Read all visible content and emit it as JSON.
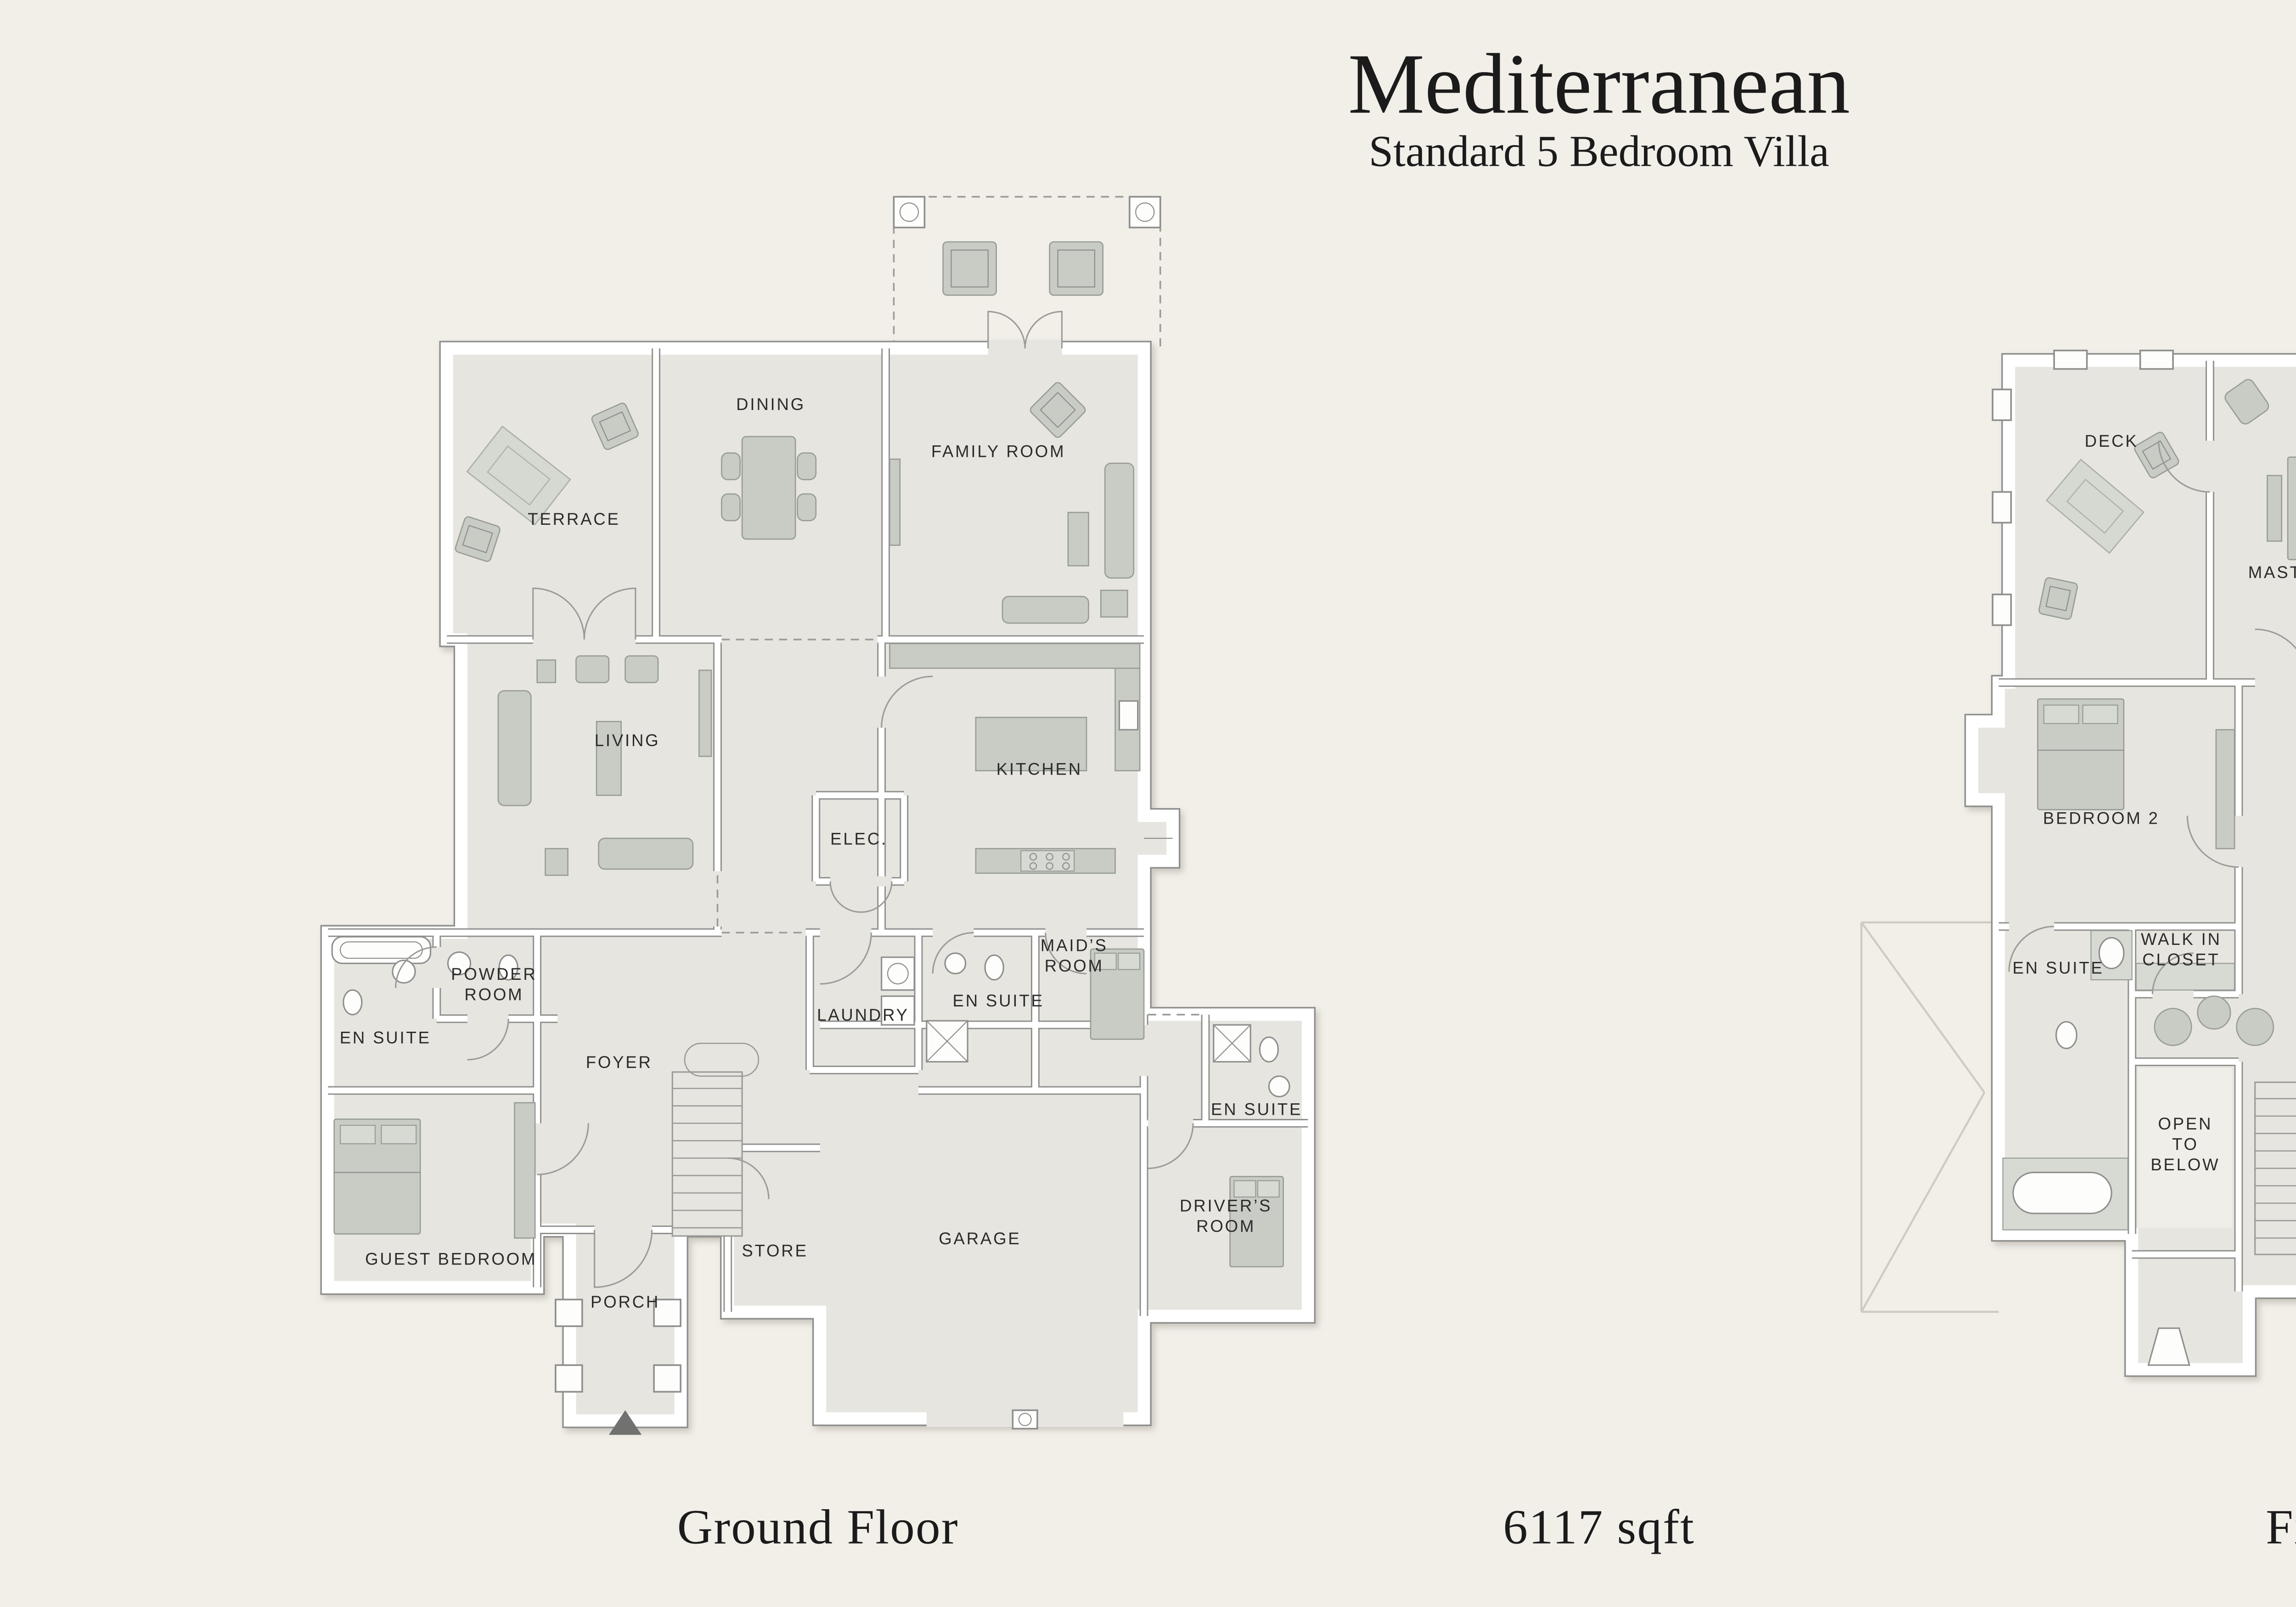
{
  "title": "Mediterranean",
  "subtitle": "Standard 5 Bedroom Villa",
  "area_label": "6117 sqft",
  "floors": {
    "ground": {
      "name": "Ground Floor",
      "rooms": {
        "terrace": "TERRACE",
        "dining": "DINING",
        "family_room": "FAMILY ROOM",
        "living": "LIVING",
        "kitchen": "KITCHEN",
        "elec": "ELEC.",
        "maids_room": [
          "MAID’S",
          "ROOM"
        ],
        "powder_room": [
          "POWDER",
          "ROOM"
        ],
        "en_suite_guest": "EN SUITE",
        "foyer": "FOYER",
        "laundry": "LAUNDRY",
        "en_suite_maid": "EN SUITE",
        "guest_bedroom": "GUEST BEDROOM",
        "store": "STORE",
        "porch": "PORCH",
        "garage": "GARAGE",
        "drivers_room": [
          "DRIVER’S",
          "ROOM"
        ],
        "en_suite_driver": "EN SUITE"
      }
    },
    "first": {
      "name": "First Floor",
      "rooms": {
        "deck_upper": "DECK",
        "master_bedroom": "MASTER BEDROOM",
        "master_bathroom": [
          "MASTER",
          "BATHROOM"
        ],
        "walk_in_closet_master": [
          "WALK IN",
          "CLOSET"
        ],
        "bedroom_2": "BEDROOM 2",
        "bedroom_3": "BEDROOM 3",
        "en_suite_2": "EN SUITE",
        "walk_in_closet_2": [
          "WALK IN",
          "CLOSET"
        ],
        "open_to_below": [
          "OPEN",
          "TO",
          "BELOW"
        ],
        "en_suite_3": "EN SUITE",
        "en_suite_4": "EN SUITE",
        "bedroom_4": "BEDROOM 4",
        "walk_in_closet_4": [
          "WALK IN",
          "CLOSET"
        ],
        "deck_lower": "DECK"
      }
    }
  },
  "colors": {
    "background": "#F2EFE9",
    "room_fill": "#E7E5DF",
    "wall_line": "#8E8E8C",
    "furniture": "#C8CCC5",
    "label": "#2B2B2B"
  }
}
